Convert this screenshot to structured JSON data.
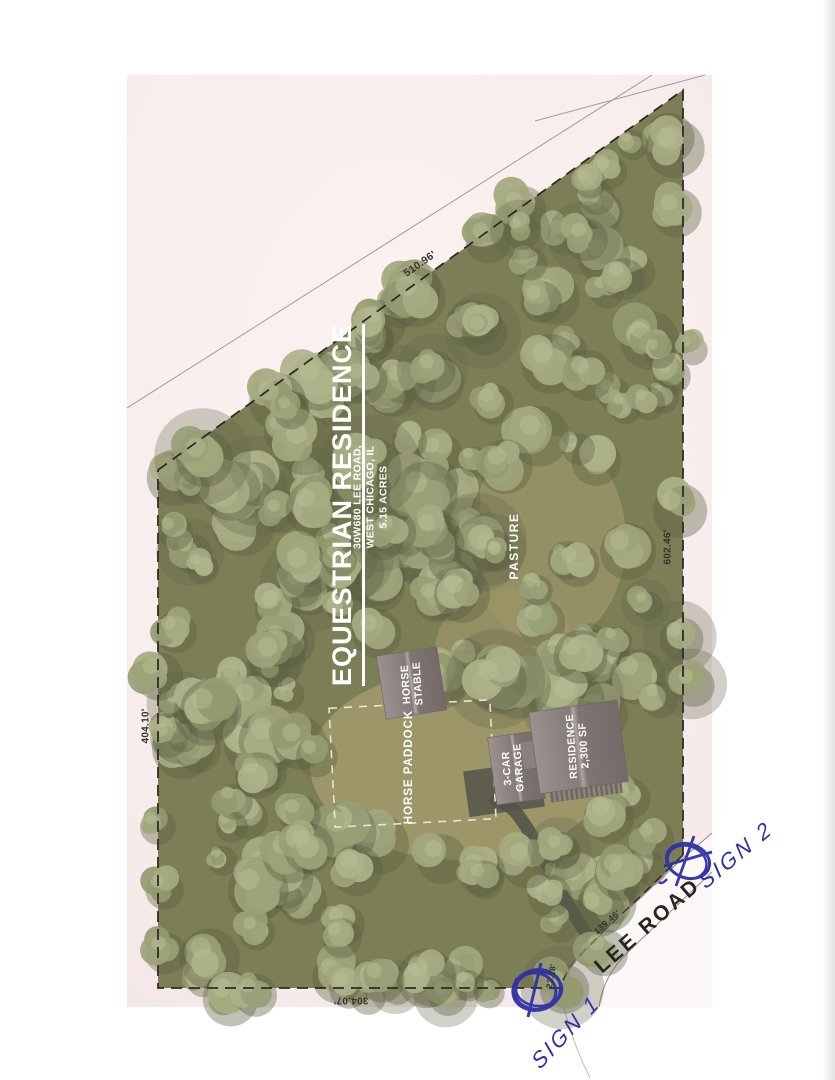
{
  "plan": {
    "title": "EQUESTRIAN RESIDENCE",
    "address": {
      "line1": "30W680 LEE ROAD,",
      "line2": "WEST CHICAGO, IL",
      "line3": "5.15 ACRES"
    },
    "areas": {
      "pasture": "PASTURE",
      "paddock": "HORSE PADDOCK"
    },
    "buildings": {
      "stable_line1": "HORSE",
      "stable_line2": "STABLE",
      "garage_line1": "3-CAR",
      "garage_line2": "GARAGE",
      "residence_line1": "RESIDENCE",
      "residence_line2": "2,300 SF"
    },
    "road": {
      "name": "LEE ROAD"
    },
    "dimensions": {
      "north_boundary": "510.96'",
      "east_boundary": "602.46'",
      "west_boundary": "404.10'",
      "south_boundary": "304.07'",
      "road_frontage": "139.46'",
      "corner_segment": "23.18'"
    },
    "annotations": {
      "sign1": "SIGN 1",
      "sign2": "SIGN 2"
    },
    "colors": {
      "ink_blue": "#2e31a5",
      "paper_pink": "#f8edec",
      "forest_floor": "#7c7f55",
      "tree_sage": "#a6ab82",
      "clearing_olive": "#9c9668",
      "roof_gray": "#8b807e",
      "boundary_dark": "#2f2c25"
    }
  }
}
